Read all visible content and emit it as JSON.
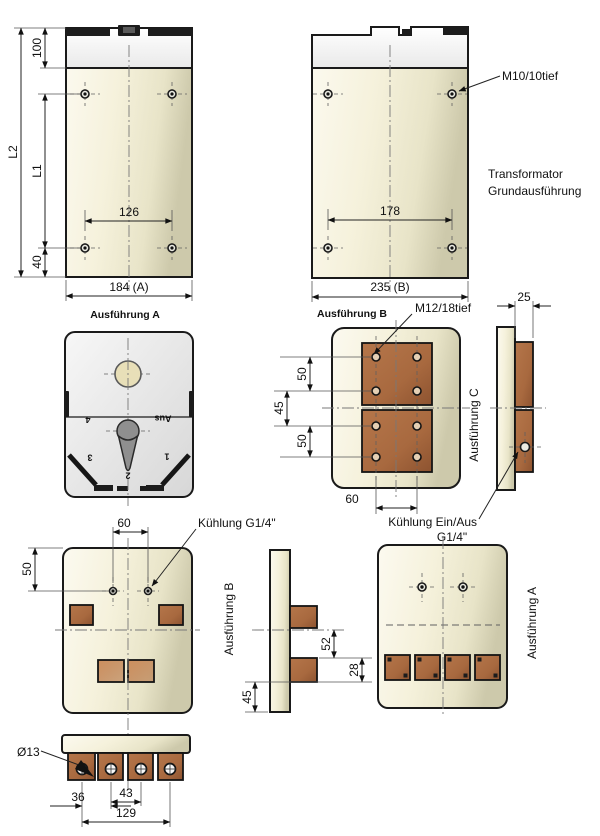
{
  "captions": {
    "front_a": "Ausführung A",
    "front_b": "Ausführung B"
  },
  "side_labels": {
    "view_b": "Ausführung B",
    "view_c": "Ausführung C",
    "view_a": "Ausführung A"
  },
  "callouts": {
    "m10": "M10/10tief",
    "m12": "M12/18tief",
    "transformer_line1": "Transformator",
    "transformer_line2": "Grundausführung",
    "cooling_g14": "Kühlung G1/4\"",
    "cooling_onoff": "Kühlung Ein/Aus",
    "cooling_onoff_g14": "G1/4\"",
    "dia13": "Ø13"
  },
  "dims": {
    "front": {
      "h100": "100",
      "l2": "L2",
      "l1": "L1",
      "h40": "40",
      "holes_a": "126",
      "width_a": "184 (A)",
      "holes_b": "178",
      "width_b": "235 (B)"
    },
    "bus": {
      "top50": "50",
      "mid45": "45",
      "bot50": "50",
      "holes60": "60",
      "depth25": "25"
    },
    "cool": {
      "holes60": "60",
      "left50": "50"
    },
    "side": {
      "v52": "52",
      "v28": "28",
      "v45": "45"
    },
    "bottom": {
      "w36": "36",
      "w43": "43",
      "w129": "129"
    }
  },
  "switch": {
    "pos4": "4",
    "aus": "Aus",
    "pos3": "3",
    "pos1": "1",
    "pos2": "2"
  },
  "colors": {
    "body_beige": "#f0ecd4",
    "body_beige_dark": "#cdc9ab",
    "white_section": "#ffffff",
    "switch_gray": "#e9e9e9",
    "copper": "#a8693f",
    "copper_light": "#c1854f",
    "detail_black": "#1c1c1c",
    "line": "#1a1a1a"
  }
}
